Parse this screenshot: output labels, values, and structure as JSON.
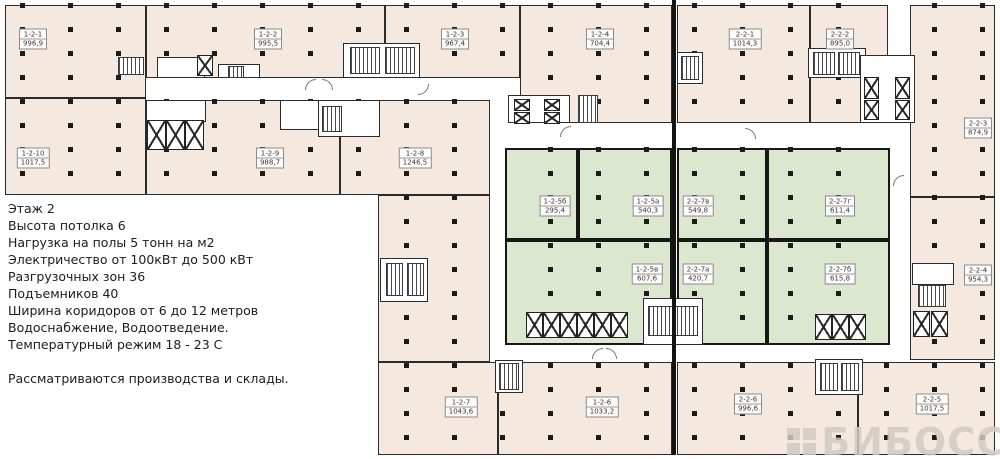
{
  "info_panel": {
    "lines": [
      "Этаж 2",
      "Высота потолка 6",
      "Нагрузка на полы 5 тонн на м2",
      "Электричество от 100кВт до 500 кВт",
      "Разгрузочных зон 36",
      "Подъемников 40",
      "Ширина коридоров от 6 до 12 метров",
      "Водоснабжение, Водоотведение.",
      "Температурный режим 18 - 23 С",
      "",
      "Рассматриваются производства и склады."
    ]
  },
  "rooms": [
    {
      "code": "1-2-1",
      "area": "996,9",
      "x": 33,
      "y": 39
    },
    {
      "code": "1-2-2",
      "area": "995,5",
      "x": 268,
      "y": 39
    },
    {
      "code": "1-2-3",
      "area": "967,4",
      "x": 455,
      "y": 39
    },
    {
      "code": "1-2-4",
      "area": "704,4",
      "x": 600,
      "y": 39
    },
    {
      "code": "2-2-1",
      "area": "1014,3",
      "x": 745,
      "y": 39
    },
    {
      "code": "2-2-2",
      "area": "895,0",
      "x": 840,
      "y": 39
    },
    {
      "code": "2-2-3",
      "area": "874,9",
      "x": 978,
      "y": 128
    },
    {
      "code": "1-2-10",
      "area": "1017,5",
      "x": 33,
      "y": 158
    },
    {
      "code": "1-2-9",
      "area": "988,7",
      "x": 270,
      "y": 158
    },
    {
      "code": "1-2-8",
      "area": "1246,5",
      "x": 415,
      "y": 158
    },
    {
      "code": "1-2-5б",
      "area": "295,4",
      "x": 555,
      "y": 206
    },
    {
      "code": "1-2-5а",
      "area": "540,3",
      "x": 648,
      "y": 206
    },
    {
      "code": "2-2-7в",
      "area": "549,8",
      "x": 698,
      "y": 206
    },
    {
      "code": "2-2-7г",
      "area": "611,4",
      "x": 840,
      "y": 206
    },
    {
      "code": "1-2-5в",
      "area": "607,6",
      "x": 647,
      "y": 274
    },
    {
      "code": "2-2-7а",
      "area": "420,7",
      "x": 698,
      "y": 274
    },
    {
      "code": "2-2-7б",
      "area": "615,8",
      "x": 840,
      "y": 274
    },
    {
      "code": "2-2-4",
      "area": "954,3",
      "x": 978,
      "y": 275
    },
    {
      "code": "1-2-7",
      "area": "1043,6",
      "x": 461,
      "y": 407
    },
    {
      "code": "1-2-6",
      "area": "1033,2",
      "x": 602,
      "y": 407
    },
    {
      "code": "2-2-6",
      "area": "996,6",
      "x": 748,
      "y": 404
    },
    {
      "code": "2-2-5",
      "area": "1017,5",
      "x": 932,
      "y": 404
    }
  ],
  "watermark": {
    "text": "БИБОСС"
  },
  "colors": {
    "room_beige": "#f5e9df",
    "room_green": "#dbe7cf",
    "wall": "#2b2b2b",
    "column": "#1c1c1c",
    "watermark_gray": "#d0cac4"
  }
}
